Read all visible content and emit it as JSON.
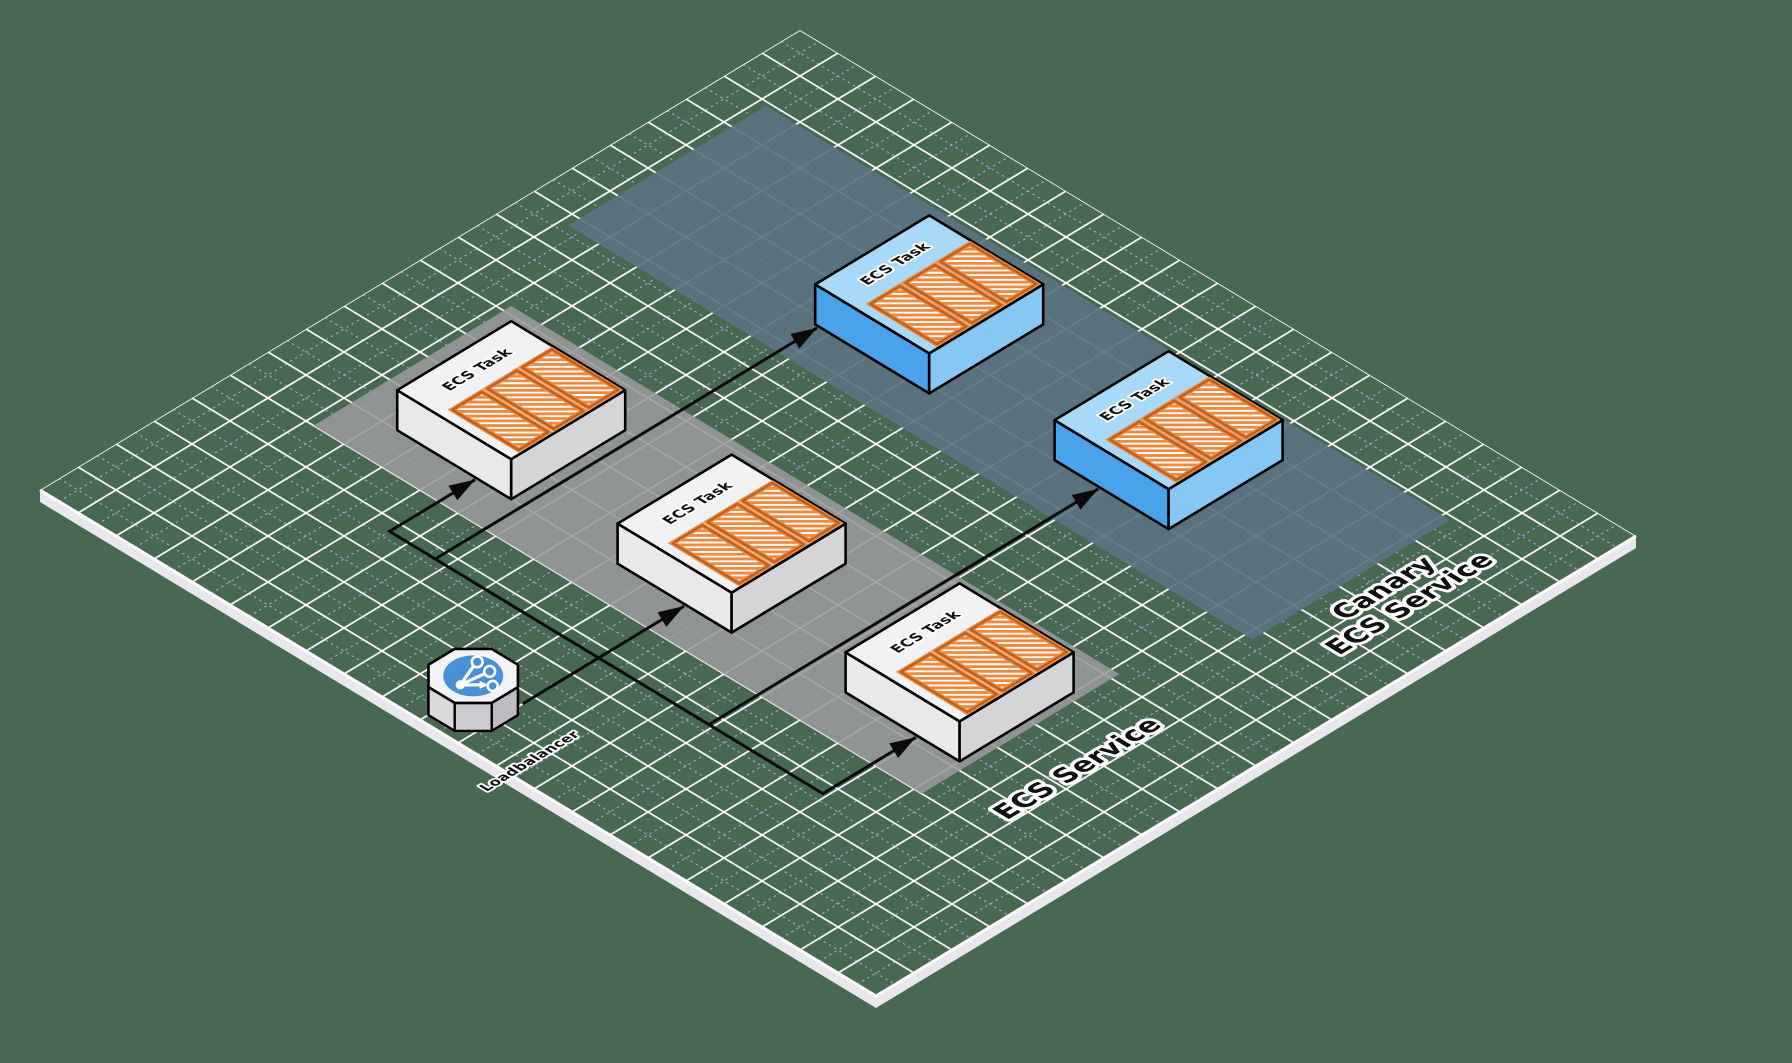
{
  "diagram": {
    "title": "ECS canary deployment isometric diagram",
    "colors": {
      "background": "#486852",
      "grid_major": "#ffffff",
      "grid_minor": "#a9b2dd",
      "edge_strip": "#e7e7ec",
      "edge_line": "#ffffff",
      "connector": "#0a0a0a",
      "text_fill": "#101010",
      "text_halo": "#ffffff",
      "task_light": {
        "top": "#f2f2f4",
        "sw": "#e9e9eb",
        "se": "#d5d5d8",
        "outline": "#000000"
      },
      "task_blue": {
        "top": "#a9d9f8",
        "sw": "#4aa2ea",
        "se": "#87c7f3",
        "outline": "#000000"
      },
      "container": {
        "fill": "#ee8a3f",
        "stripe": "#ffffff",
        "outline": "#bc5f1c"
      },
      "loadbalancer": {
        "top": "#f3f3f5",
        "side_light": "#dadadd",
        "side_mid": "#cbcbcf",
        "side_dark": "#bcbcc1",
        "circle": "#4a90d9",
        "glyph": "#ffffff",
        "outline": "#000000"
      }
    },
    "plane": {
      "origin": [
        40,
        490
      ],
      "dx": 38,
      "dy": 23,
      "u_tiles": 20,
      "v_tiles": 22,
      "edge_thickness": 12
    },
    "grid": {
      "major_width": 1.8,
      "minor_width": 1.2,
      "minor_dash": "2.5 3.5",
      "major_opacity": 0.95,
      "minor_opacity": 0.85
    },
    "bands": [
      {
        "id": "ecs-service",
        "label_lines": [
          "ECS Service"
        ],
        "u1": 5.0,
        "u2": 10.2,
        "v1": 2.2,
        "v2": 18.2,
        "fill": "#98989a",
        "opacity": 0.88,
        "label_pos": [
          7.6,
          19.7
        ],
        "label_size": 27
      },
      {
        "id": "canary-ecs-service",
        "label_lines": [
          "Canary",
          "ECS Service"
        ],
        "u1": 12.7,
        "u2": 17.9,
        "v1": 1.2,
        "v2": 19.2,
        "fill": "#5a7380",
        "opacity": 0.93,
        "label_pos": [
          15.55,
          20.15
        ],
        "label_size": 27
      }
    ],
    "nodes": [
      {
        "id": "ecs-task-1",
        "type": "ecs-task",
        "icon": "containers-icon",
        "label": "ECS Task",
        "u": 6.0,
        "v": 3.4,
        "size": 3,
        "height": 40,
        "palette": "task_light"
      },
      {
        "id": "ecs-task-2",
        "type": "ecs-task",
        "icon": "containers-icon",
        "label": "ECS Task",
        "u": 6.0,
        "v": 9.2,
        "size": 3,
        "height": 40,
        "palette": "task_light"
      },
      {
        "id": "ecs-task-3",
        "type": "ecs-task",
        "icon": "containers-icon",
        "label": "ECS Task",
        "u": 6.2,
        "v": 15.0,
        "size": 3,
        "height": 40,
        "palette": "task_light"
      },
      {
        "id": "canary-task-1",
        "type": "ecs-task",
        "icon": "containers-icon",
        "label": "ECS Task",
        "u": 13.8,
        "v": 6.6,
        "size": 3,
        "height": 40,
        "palette": "task_blue"
      },
      {
        "id": "canary-task-2",
        "type": "ecs-task",
        "icon": "containers-icon",
        "label": "ECS Task",
        "u": 14.0,
        "v": 12.7,
        "size": 3,
        "height": 40,
        "palette": "task_blue"
      },
      {
        "id": "loadbalancer",
        "type": "loadbalancer",
        "icon": "branch-arrows-icon",
        "label": "Loadbalancer",
        "u": 1.05,
        "v": 10.35,
        "radius": 0.9,
        "height": 28,
        "label_pos": [
          0.55,
          12.35
        ]
      }
    ],
    "connectors": [
      {
        "id": "lb-to-task-2",
        "points": [
          [
            1.7,
            11.0
          ],
          [
            5.95,
            11.0
          ]
        ]
      },
      {
        "id": "lb-to-task-1",
        "points": [
          [
            3.7,
            11.0
          ],
          [
            3.7,
            5.5
          ],
          [
            5.95,
            5.5
          ]
        ]
      },
      {
        "id": "lb-to-canary-task-1",
        "points": [
          [
            3.7,
            6.7
          ],
          [
            13.75,
            6.7
          ]
        ]
      },
      {
        "id": "lb-to-task-3",
        "points": [
          [
            3.7,
            11.0
          ],
          [
            3.7,
            16.9
          ],
          [
            6.15,
            16.9
          ]
        ]
      },
      {
        "id": "lb-to-canary-task-2",
        "points": [
          [
            3.7,
            13.9
          ],
          [
            13.95,
            13.9
          ]
        ]
      }
    ],
    "connector_style": {
      "width": 3,
      "arrow_length": 26,
      "arrow_half_width": 8.5
    },
    "task_label_size": 14.5,
    "lb_label_size": 14
  }
}
